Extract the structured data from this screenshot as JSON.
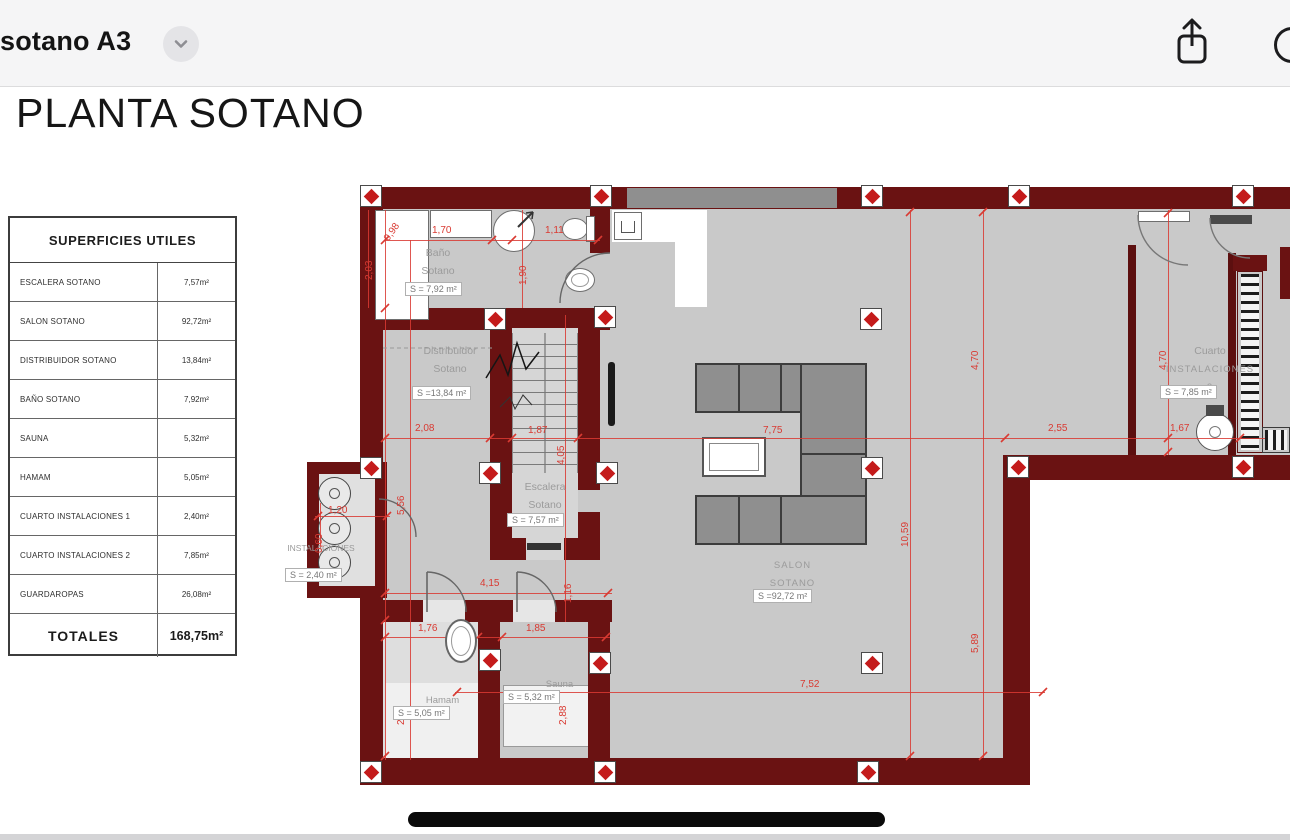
{
  "header": {
    "title": "sotano A3"
  },
  "doc": {
    "title": "PLANTA SOTANO"
  },
  "table": {
    "header": "SUPERFICIES UTILES",
    "rows": [
      {
        "label": "ESCALERA SOTANO",
        "value": "7,57m²"
      },
      {
        "label": "SALON SOTANO",
        "value": "92,72m²"
      },
      {
        "label": "DISTRIBUIDOR SOTANO",
        "value": "13,84m²"
      },
      {
        "label": "BAÑO SOTANO",
        "value": "7,92m²"
      },
      {
        "label": "SAUNA",
        "value": "5,32m²"
      },
      {
        "label": "HAMAM",
        "value": "5,05m²"
      },
      {
        "label": "CUARTO INSTALACIONES 1",
        "value": "2,40m²"
      },
      {
        "label": "CUARTO INSTALACIONES 2",
        "value": "7,85m²"
      },
      {
        "label": "GUARDAROPAS",
        "value": "26,08m²"
      }
    ],
    "total": {
      "label": "TOTALES",
      "value": "168,75m²"
    }
  },
  "plan": {
    "rooms": [
      {
        "name1": "Baño",
        "name2": "Sotano",
        "area": "S = 7,92 m²"
      },
      {
        "name1": "Distribuidor",
        "name2": "Sotano",
        "area": "S =13,84 m²"
      },
      {
        "name1": "Escalera",
        "name2": "Sotano",
        "area": "S = 7,57 m²"
      },
      {
        "name1": "SALON",
        "name2": "SOTANO",
        "area": "S =92,72 m²"
      },
      {
        "name1": "Cuarto",
        "name2": "INSTALACIONES",
        "name3": "2",
        "area": "S = 7,85 m²"
      },
      {
        "name1": "INSTALACIONES",
        "area": "S = 2,40 m²"
      },
      {
        "name1": "Hamam",
        "area": "S = 5,05 m²"
      },
      {
        "name1": "Sauna",
        "area": "S = 5,32 m²"
      }
    ],
    "dims": [
      "0,98",
      "2,03",
      "1,70",
      "1,11",
      "1,90",
      "4,70",
      "4,70",
      "2,08",
      "1,87",
      "7,75",
      "2,55",
      "1,67",
      "5,56",
      "4,05",
      "10,59",
      "1,20",
      "0,60",
      "4,15",
      "1,16",
      "5,89",
      "1,76",
      "1,85",
      "2,88",
      "2,88",
      "7,52"
    ],
    "colors": {
      "wall": "#6a1212",
      "floor": "#c9c9c9",
      "dimension": "#d93a32",
      "marker": "#c41b1b",
      "band": "#8f8f8f"
    }
  }
}
